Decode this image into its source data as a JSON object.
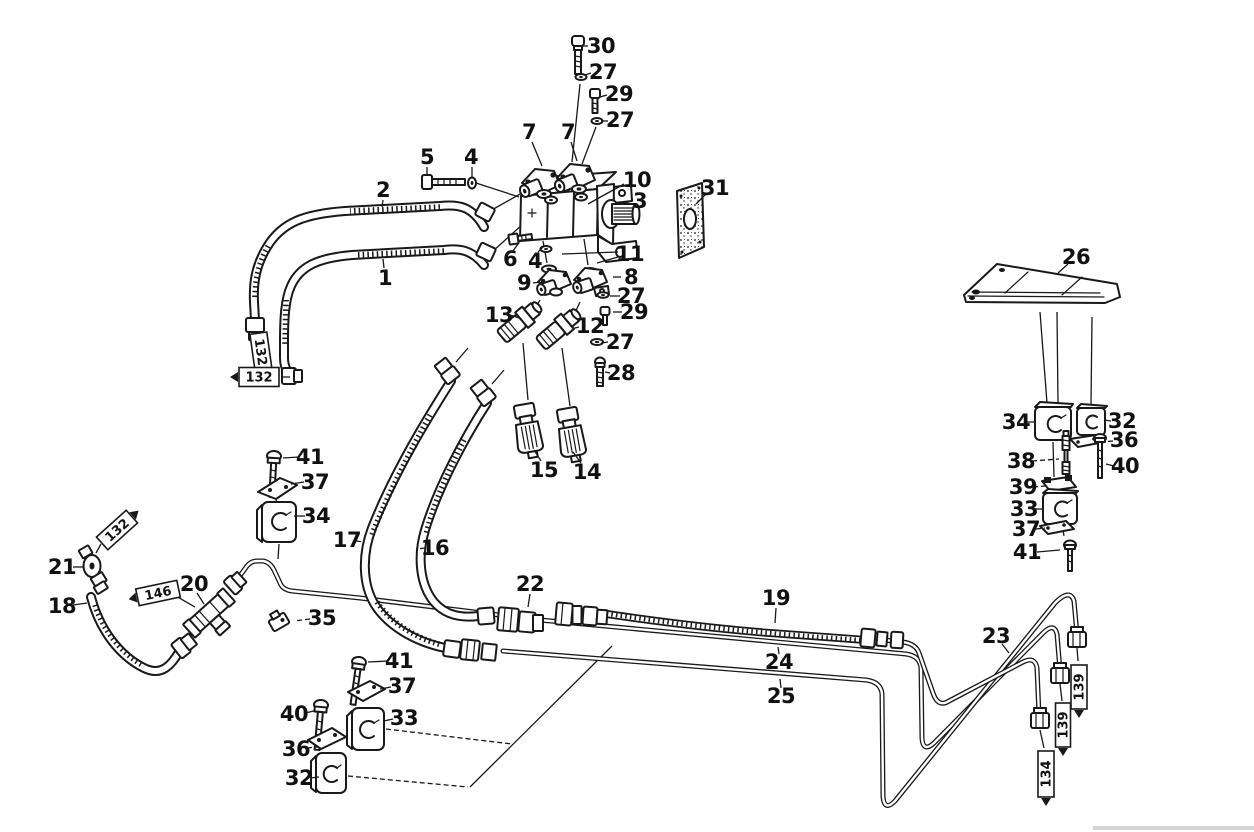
{
  "figure": {
    "kind": "exploded-parts-line-drawing",
    "subject": "hydraulic pump, hoses and lines parts diagram",
    "ink_color": "#191919",
    "paper_color": "#ffffff"
  },
  "callouts": [
    {
      "n": "30",
      "x": 601,
      "y": 53,
      "leader": [
        588,
        46,
        580,
        46
      ]
    },
    {
      "n": "27",
      "x": 603,
      "y": 79,
      "leader": [
        591,
        73,
        585,
        75
      ]
    },
    {
      "n": "29",
      "x": 619,
      "y": 101,
      "leader": [
        607,
        95,
        600,
        97
      ]
    },
    {
      "n": "27",
      "x": 620,
      "y": 127,
      "leader": [
        608,
        121,
        601,
        121
      ]
    },
    {
      "n": "7",
      "x": 529,
      "y": 139,
      "leader": [
        532,
        142,
        542,
        166
      ]
    },
    {
      "n": "7",
      "x": 568,
      "y": 139,
      "leader": [
        571,
        142,
        577,
        161
      ]
    },
    {
      "n": "5",
      "x": 427,
      "y": 164,
      "leader": [
        427,
        167,
        427,
        175
      ]
    },
    {
      "n": "4",
      "x": 471,
      "y": 164,
      "leader": [
        472,
        167,
        472,
        177
      ]
    },
    {
      "n": "2",
      "x": 383,
      "y": 197,
      "leader": [
        383,
        200,
        382,
        207
      ]
    },
    {
      "n": "10",
      "x": 637,
      "y": 187,
      "leader": [
        624,
        184,
        588,
        204
      ]
    },
    {
      "n": "3",
      "x": 640,
      "y": 208,
      "leader": [
        629,
        202,
        616,
        204
      ]
    },
    {
      "n": "31",
      "x": 715,
      "y": 195,
      "leader": [
        706,
        194,
        696,
        204
      ]
    },
    {
      "n": "1",
      "x": 385,
      "y": 285,
      "leader": [
        384,
        268,
        383,
        259
      ]
    },
    {
      "n": "6",
      "x": 510,
      "y": 266,
      "leader": [
        513,
        251,
        518,
        244
      ]
    },
    {
      "n": "4",
      "x": 535,
      "y": 268,
      "leader": [
        538,
        252,
        544,
        246
      ]
    },
    {
      "n": "9",
      "x": 524,
      "y": 290,
      "leader": [
        533,
        283,
        540,
        282
      ]
    },
    {
      "n": "11",
      "x": 630,
      "y": 261,
      "leader": [
        618,
        252,
        562,
        254
      ],
      "leader2": [
        618,
        257,
        597,
        263
      ]
    },
    {
      "n": "8",
      "x": 631,
      "y": 284,
      "leader": [
        621,
        277,
        613,
        277
      ]
    },
    {
      "n": "27",
      "x": 631,
      "y": 303,
      "leader": [
        620,
        296,
        610,
        296
      ]
    },
    {
      "n": "29",
      "x": 634,
      "y": 319,
      "leader": [
        622,
        312,
        613,
        312
      ]
    },
    {
      "n": "13",
      "x": 499,
      "y": 322,
      "leader": [
        510,
        315,
        519,
        318
      ]
    },
    {
      "n": "12",
      "x": 590,
      "y": 333,
      "leader": [
        579,
        327,
        571,
        329
      ],
      "dash": true
    },
    {
      "n": "27",
      "x": 620,
      "y": 349,
      "leader": [
        608,
        342,
        601,
        343
      ]
    },
    {
      "n": "28",
      "x": 621,
      "y": 380,
      "leader": [
        610,
        373,
        605,
        372
      ]
    },
    {
      "n": "15",
      "x": 544,
      "y": 477,
      "leader": [
        541,
        461,
        534,
        450
      ]
    },
    {
      "n": "14",
      "x": 587,
      "y": 479,
      "leader": [
        581,
        463,
        573,
        452
      ]
    },
    {
      "n": "41",
      "x": 310,
      "y": 464,
      "leader": [
        299,
        457,
        283,
        458
      ]
    },
    {
      "n": "37",
      "x": 315,
      "y": 489,
      "leader": [
        304,
        482,
        291,
        484
      ]
    },
    {
      "n": "34",
      "x": 316,
      "y": 523,
      "leader": [
        305,
        516,
        294,
        516
      ]
    },
    {
      "n": "17",
      "x": 347,
      "y": 547,
      "leader": [
        356,
        541,
        364,
        542
      ],
      "dash": true
    },
    {
      "n": "16",
      "x": 435,
      "y": 555,
      "leader": [
        425,
        548,
        416,
        549
      ],
      "dash": true
    },
    {
      "n": "21",
      "x": 62,
      "y": 574,
      "leader": [
        73,
        567,
        84,
        567
      ]
    },
    {
      "n": "18",
      "x": 62,
      "y": 613,
      "leader": [
        73,
        605,
        87,
        603
      ]
    },
    {
      "n": "20",
      "x": 194,
      "y": 591,
      "leader": [
        197,
        593,
        204,
        604
      ]
    },
    {
      "n": "35",
      "x": 322,
      "y": 625,
      "leader": [
        310,
        619,
        294,
        621
      ],
      "dash": true
    },
    {
      "n": "22",
      "x": 530,
      "y": 591,
      "leader": [
        530,
        594,
        528,
        607
      ]
    },
    {
      "n": "19",
      "x": 776,
      "y": 605,
      "leader": [
        776,
        608,
        775,
        623
      ]
    },
    {
      "n": "24",
      "x": 779,
      "y": 669,
      "leader": [
        779,
        654,
        778,
        647
      ]
    },
    {
      "n": "25",
      "x": 781,
      "y": 703,
      "leader": [
        781,
        688,
        780,
        679
      ]
    },
    {
      "n": "23",
      "x": 996,
      "y": 643,
      "leader": [
        1002,
        644,
        1009,
        653
      ]
    },
    {
      "n": "26",
      "x": 1076,
      "y": 264,
      "leader": [
        1068,
        264,
        1058,
        273
      ]
    },
    {
      "n": "34",
      "x": 1016,
      "y": 429,
      "leader": [
        1027,
        422,
        1035,
        422
      ]
    },
    {
      "n": "32",
      "x": 1122,
      "y": 428,
      "leader": [
        1111,
        421,
        1104,
        420
      ]
    },
    {
      "n": "36",
      "x": 1124,
      "y": 447,
      "leader": [
        1113,
        441,
        1101,
        442
      ],
      "dash": true
    },
    {
      "n": "38",
      "x": 1021,
      "y": 468,
      "leader": [
        1032,
        461,
        1059,
        459
      ],
      "dash": true
    },
    {
      "n": "40",
      "x": 1125,
      "y": 473,
      "leader": [
        1114,
        466,
        1106,
        464
      ]
    },
    {
      "n": "39",
      "x": 1023,
      "y": 494,
      "leader": [
        1033,
        487,
        1045,
        486
      ],
      "dash": true
    },
    {
      "n": "33",
      "x": 1024,
      "y": 516,
      "leader": [
        1034,
        509,
        1042,
        509
      ]
    },
    {
      "n": "37",
      "x": 1026,
      "y": 536,
      "leader": [
        1036,
        529,
        1045,
        528
      ],
      "dash": true
    },
    {
      "n": "41",
      "x": 1027,
      "y": 559,
      "leader": [
        1037,
        552,
        1060,
        550
      ]
    },
    {
      "n": "41",
      "x": 399,
      "y": 668,
      "leader": [
        388,
        661,
        368,
        662
      ]
    },
    {
      "n": "37",
      "x": 402,
      "y": 693,
      "leader": [
        391,
        687,
        380,
        689
      ]
    },
    {
      "n": "40",
      "x": 294,
      "y": 721,
      "leader": [
        305,
        713,
        314,
        711
      ]
    },
    {
      "n": "33",
      "x": 404,
      "y": 725,
      "leader": [
        393,
        719,
        384,
        721
      ]
    },
    {
      "n": "36",
      "x": 296,
      "y": 756,
      "leader": [
        307,
        748,
        317,
        747
      ],
      "dash": true
    },
    {
      "n": "32",
      "x": 299,
      "y": 785,
      "leader": [
        310,
        778,
        319,
        777
      ]
    }
  ],
  "tags": [
    {
      "text": "132",
      "cx": 261,
      "cy": 352,
      "rot": 82,
      "w": 38,
      "h": 17,
      "arrow": null,
      "leader": null
    },
    {
      "text": "132",
      "cx": 259,
      "cy": 377,
      "rot": 0,
      "w": 40,
      "h": 19,
      "arrow": "start",
      "leader": [
        282,
        377,
        290,
        377
      ]
    },
    {
      "text": "132",
      "cx": 117,
      "cy": 530,
      "rot": -42,
      "w": 40,
      "h": 17,
      "arrow": "end",
      "leader": [
        101,
        544,
        96,
        553
      ]
    },
    {
      "text": "146",
      "cx": 158,
      "cy": 593,
      "rot": -12,
      "w": 42,
      "h": 17,
      "arrow": "start",
      "leader": [
        176,
        596,
        195,
        607
      ]
    },
    {
      "text": "139",
      "cx": 1079,
      "cy": 687,
      "rot": -90,
      "w": 44,
      "h": 16,
      "arrow": "start",
      "leader": [
        1077,
        648,
        1078,
        661
      ]
    },
    {
      "text": "139",
      "cx": 1063,
      "cy": 725,
      "rot": -90,
      "w": 44,
      "h": 15,
      "arrow": "start",
      "leader": [
        1060,
        684,
        1062,
        701
      ]
    },
    {
      "text": "134",
      "cx": 1046,
      "cy": 774,
      "rot": -90,
      "w": 46,
      "h": 16,
      "arrow": "start",
      "leader": [
        1040,
        730,
        1044,
        748
      ]
    }
  ]
}
